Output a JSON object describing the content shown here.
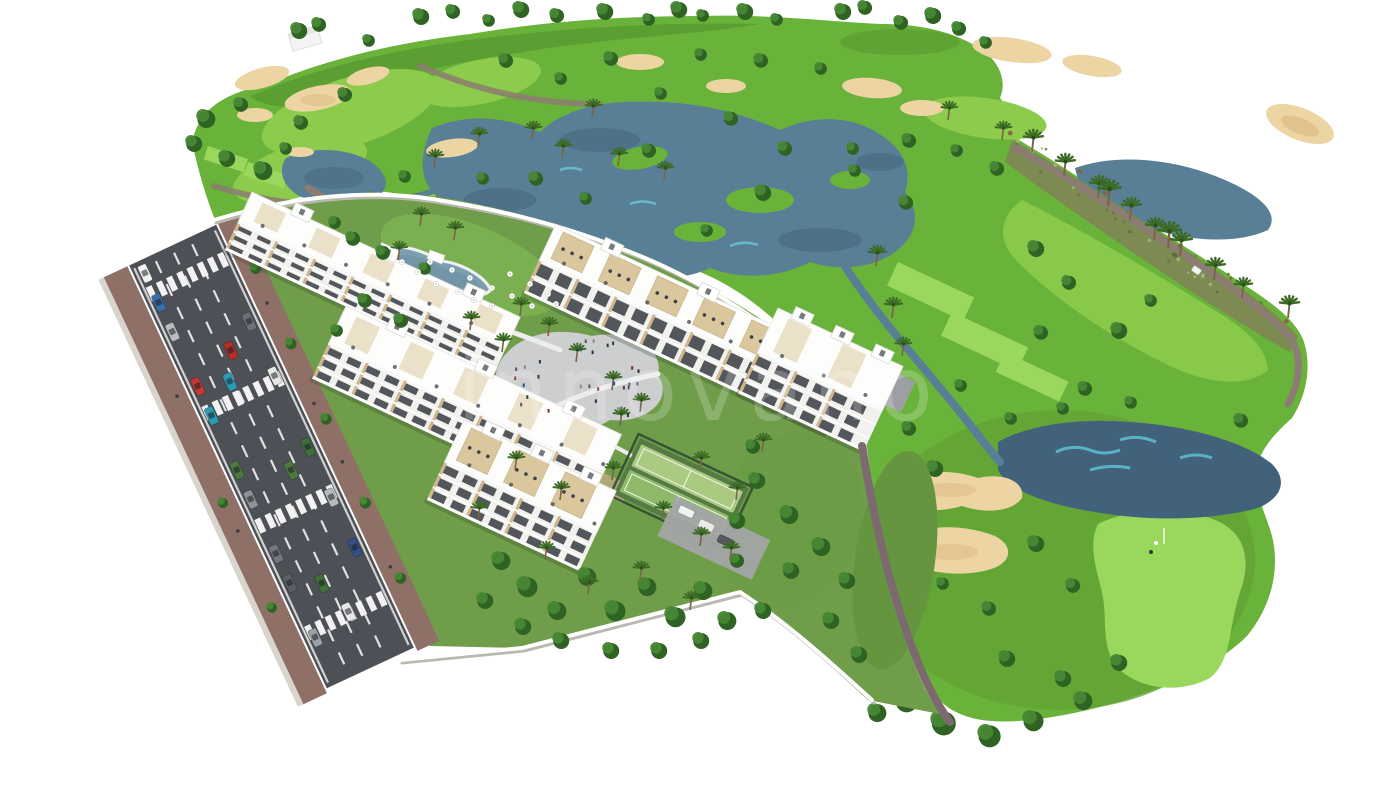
{
  "image": {
    "type": "architectural-aerial-render",
    "description": "Aerial 3D render of a white apartment complex with pools, plaza and padel court beside a golf course with lakes, sand bunkers, palm trees and an access road with parked cars",
    "watermark_text": "innovano"
  },
  "palette": {
    "bg": "#ffffff",
    "grass-mid": "#6ab33a",
    "grass-light": "#8ccb4c",
    "grass-bright": "#9ad85d",
    "grass-dark": "#4e8c2c",
    "lawn": "#6f9d49",
    "lawn-light": "#7cb251",
    "tree-dark": "#2f6323",
    "tree-light": "#478735",
    "palm": "#3c6b26",
    "sand": "#ecd5a2",
    "sand-dark": "#d9b87f",
    "water": "#587f95",
    "water-dark": "#42617a",
    "water-light": "#6fd3da",
    "path": "#8b7d71",
    "path-dark": "#7d6a6e",
    "asphalt": "#4d5056",
    "sidewalk": "#8e7066",
    "wall-shadow": "#b9b9b0",
    "building": "#ffffff",
    "building-shade": "#dcdcdc",
    "tan": "#c9a96e",
    "window": "#3c4148",
    "plaza": "#cdced0",
    "court-light": "#a9ca80",
    "court-mid": "#8fb968",
    "fence": "#2e4d33",
    "scrub": "#7d8a52"
  },
  "scene": {
    "areas": [
      "golf-course",
      "lakes",
      "sand-bunkers",
      "apartment-buildings",
      "swimming-pool",
      "central-plaza",
      "padel-court",
      "access-road",
      "gardens",
      "putting-green"
    ]
  }
}
